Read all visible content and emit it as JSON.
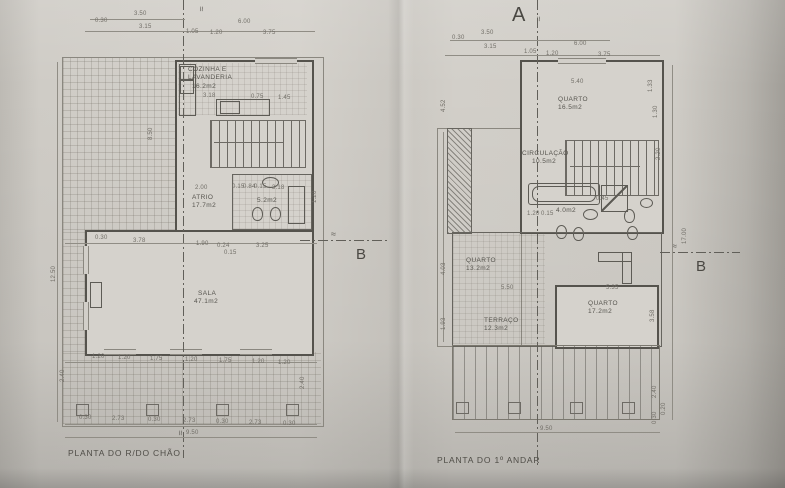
{
  "icons": {
    "break": "≈"
  },
  "markers": {
    "a": "A",
    "b": "B"
  },
  "left_plan": {
    "title": "PLANTA DO R/DO CHÃO",
    "rooms": {
      "cozinha_name1": "COZINHA E",
      "cozinha_name2": "LAVANDERIA",
      "cozinha_area": "16.2m2",
      "atrio_name": "ATRIO",
      "atrio_area": "17.7m2",
      "wc_area": "5.2m2",
      "sala_name": "SALA",
      "sala_area": "47.1m2"
    },
    "dims": {
      "top": [
        "0.30",
        "3.50",
        "3.15",
        "1.05",
        "1.20",
        "6.00",
        "3.75"
      ],
      "kitchen": [
        "3.18",
        "0.75",
        "1.45"
      ],
      "atrio_w": "2.00",
      "wc_row": [
        "0.15",
        "0.84",
        "0.15",
        "3.18"
      ],
      "wc_side": "1.20",
      "mid": [
        "0.30",
        "3.78",
        "1.90",
        "0.24",
        "0.15",
        "3.25"
      ],
      "lower": [
        "1.20",
        "1.20",
        "1.75",
        "1.20",
        "1.75",
        "1.20",
        "1.20"
      ],
      "bottom": [
        "0.30",
        "2.73",
        "0.30",
        "2.73",
        "0.30",
        "2.73",
        "0.30"
      ],
      "total": "9.50",
      "left_v": "12.50",
      "patio_v": "8.50",
      "side_v": [
        "2.40",
        "2.40"
      ]
    }
  },
  "right_plan": {
    "title": "PLANTA DO 1º ANDAR",
    "rooms": {
      "quarto1_name": "QUARTO",
      "quarto1_area": "16.5m2",
      "circ_name": "CIRCULAÇÃO",
      "circ_area": "10.5m2",
      "wc_area": "4.0m2",
      "quarto2_name": "QUARTO",
      "quarto2_area": "13.2m2",
      "terraco_name": "TERRAÇO",
      "terraco_area": "12.3m2",
      "quarto3_name": "QUARTO",
      "quarto3_area": "17.2m2"
    },
    "dims": {
      "top": [
        "0.30",
        "3.50",
        "3.15",
        "1.05",
        "1.20",
        "6.00",
        "3.75"
      ],
      "quarto1_w": "5.40",
      "right_v": [
        "1.33",
        "1.30",
        "2.20",
        "17.00"
      ],
      "left_v": [
        "4.52",
        "4.03",
        "1.93"
      ],
      "wc_row": [
        "1.20",
        "0.15",
        "0.45"
      ],
      "quarto2_w": "5.50",
      "quarto3_w": "5.35",
      "quarto3_h": "3.58",
      "bottom_total": "9.50",
      "bottom_right_v": [
        "2.40",
        "0.20",
        "0.30"
      ]
    }
  }
}
